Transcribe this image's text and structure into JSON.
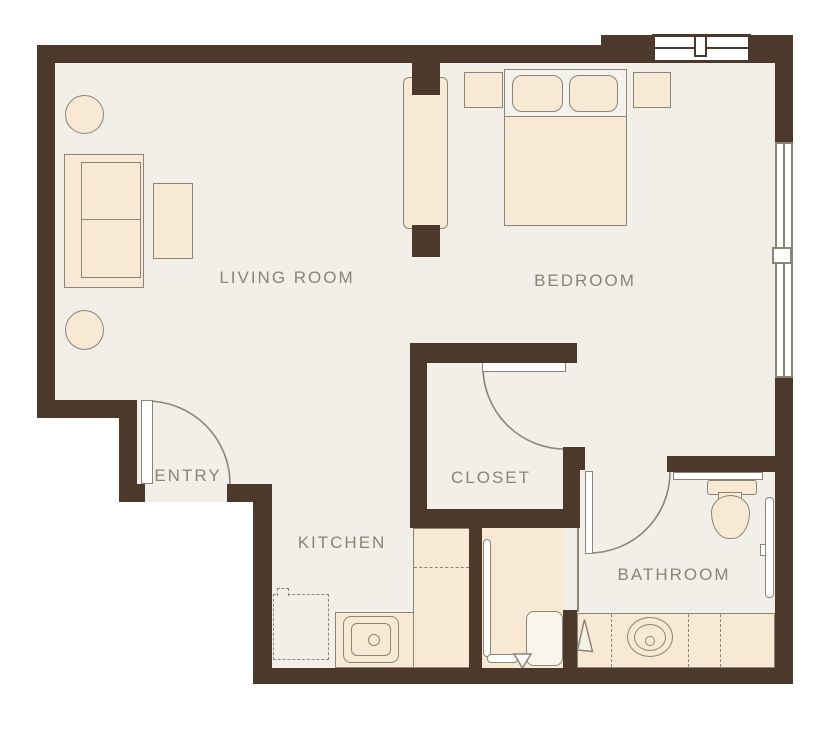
{
  "rooms": {
    "living_room": {
      "label": "LIVING ROOM"
    },
    "bedroom": {
      "label": "BEDROOM"
    },
    "entry": {
      "label": "ENTRY"
    },
    "closet": {
      "label": "CLOSET"
    },
    "kitchen": {
      "label": "KITCHEN"
    },
    "bathroom": {
      "label": "BATHROOM"
    }
  },
  "colors": {
    "wall": "#4d392b",
    "floor": "#f1efe8",
    "furniture": "#f8e9d5",
    "outline": "#8b8577",
    "label": "#8a8477"
  }
}
